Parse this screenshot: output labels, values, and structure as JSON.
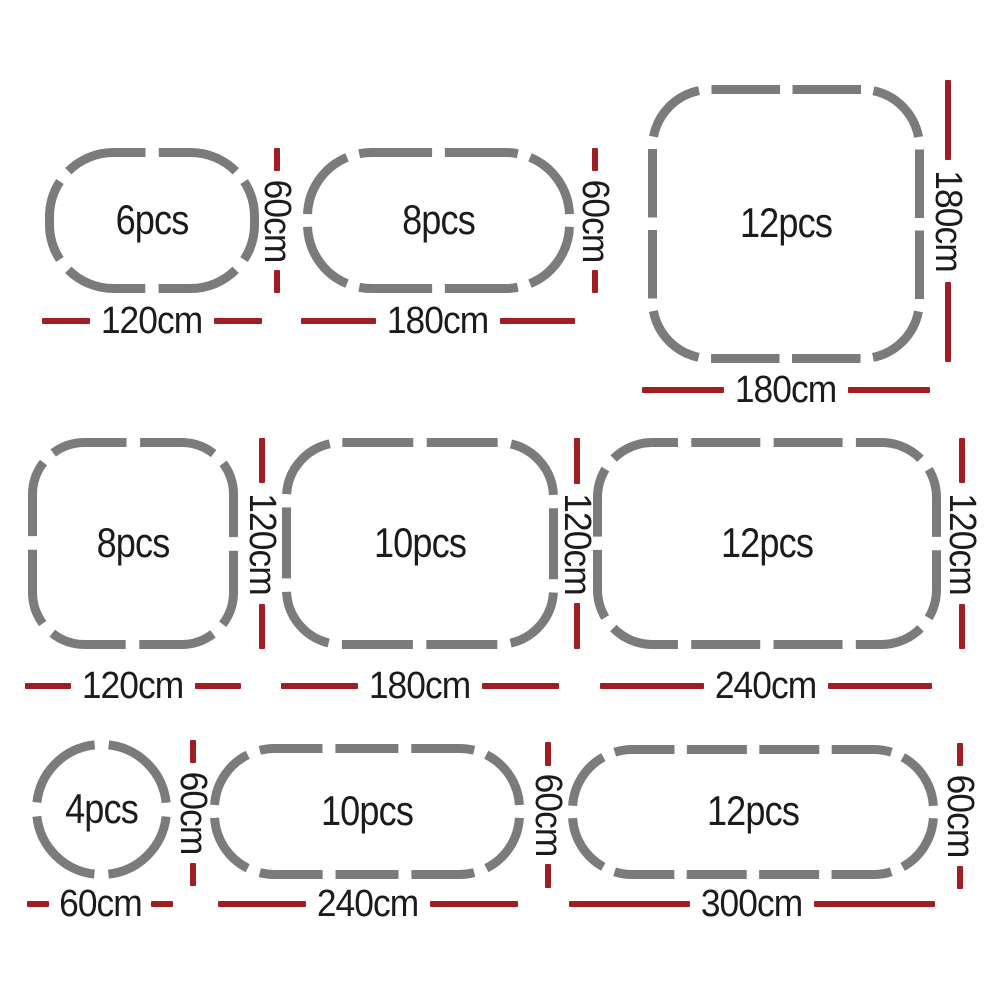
{
  "figure": {
    "description": "Pet playpen panel configuration diagram, 3 rows of dashed outline shapes",
    "background": "#ffffff"
  },
  "colors": {
    "panel_gray": "#7b7b7b",
    "dimension_red": "#a01e23",
    "label_black": "#1b1b1b"
  },
  "items": [
    {
      "shape": "oval",
      "pcs": "6pcs",
      "width": "120cm",
      "height": "60cm"
    },
    {
      "shape": "oval",
      "pcs": "8pcs",
      "width": "180cm",
      "height": "60cm"
    },
    {
      "shape": "rounded-square",
      "pcs": "12pcs",
      "width": "180cm",
      "height": "180cm"
    },
    {
      "shape": "rounded-square",
      "pcs": "8pcs",
      "width": "120cm",
      "height": "120cm"
    },
    {
      "shape": "rounded-rect",
      "pcs": "10pcs",
      "width": "180cm",
      "height": "120cm"
    },
    {
      "shape": "rounded-rect",
      "pcs": "12pcs",
      "width": "240cm",
      "height": "120cm"
    },
    {
      "shape": "circle",
      "pcs": "4pcs",
      "width": "60cm",
      "height": "60cm"
    },
    {
      "shape": "pill",
      "pcs": "10pcs",
      "width": "240cm",
      "height": "60cm"
    },
    {
      "shape": "pill",
      "pcs": "12pcs",
      "width": "300cm",
      "height": "60cm"
    }
  ]
}
